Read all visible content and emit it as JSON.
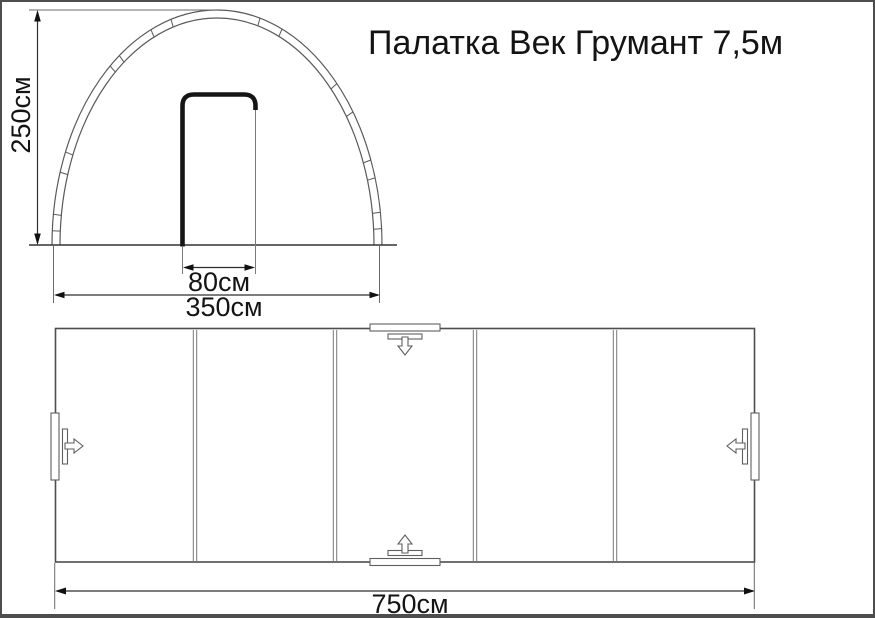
{
  "title": "Палатка Век Грумант 7,5м",
  "front_view": {
    "height_dimension": "250см",
    "door_width_dimension": "80см",
    "base_width_dimension": "350см"
  },
  "plan_view": {
    "length_dimension": "750см",
    "sections": 5,
    "entrance_markers": 4
  },
  "dimensions_cm": {
    "height": 250,
    "base_width": 350,
    "door_width": 80,
    "length": 750
  },
  "colors": {
    "background": "#ffffff",
    "line_gray": "#5a5a5a",
    "line_dark": "#2e2e2e",
    "door_bold": "#151515",
    "text": "#141414",
    "frame_border": "#4d4d4d"
  }
}
